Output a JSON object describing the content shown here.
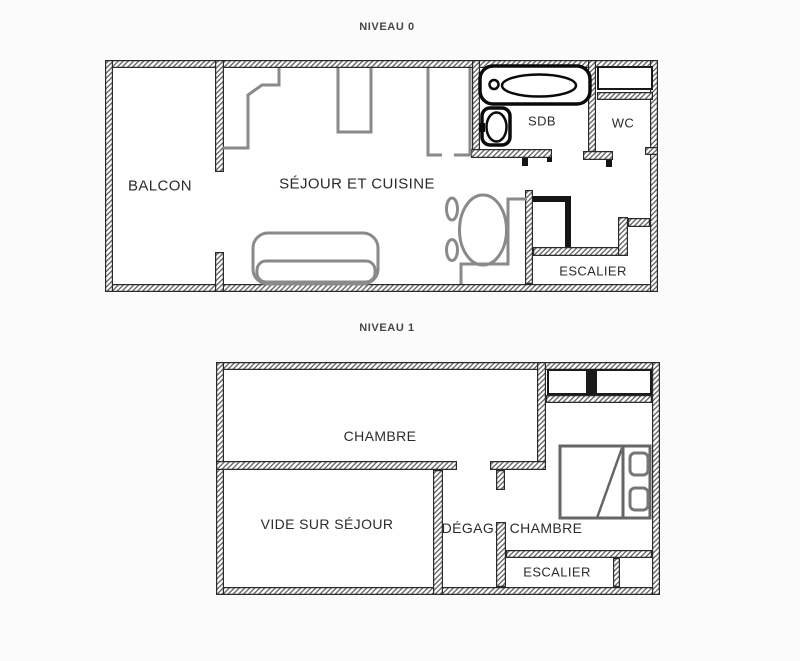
{
  "levels": [
    {
      "title": "NIVEAU 0",
      "rooms": {
        "balcon": "BALCON",
        "sejour_cuisine": "SÉJOUR ET CUISINE",
        "sdb": "SDB",
        "wc": "WC",
        "escalier": "ESCALIER"
      },
      "furniture": [
        "kitchen-counter",
        "appliance",
        "appliance",
        "bathtub",
        "washbasin",
        "sofa",
        "dining-table",
        "chair",
        "chair",
        "bench"
      ]
    },
    {
      "title": "NIVEAU 1",
      "rooms": {
        "chambre_1": "CHAMBRE",
        "vide_sur_sejour": "VIDE SUR SÉJOUR",
        "degagement": "DÉGAG.",
        "chambre_2": "CHAMBRE",
        "escalier": "ESCALIER"
      },
      "furniture": [
        "double-bed",
        "pillow",
        "pillow"
      ]
    }
  ],
  "colors": {
    "background": "#ffffff",
    "wall_line": "#2a2a2a",
    "furniture_gray": "#8a8a8a",
    "fixture_black": "#0a0a0a",
    "label_text": "#2b2b2b"
  }
}
